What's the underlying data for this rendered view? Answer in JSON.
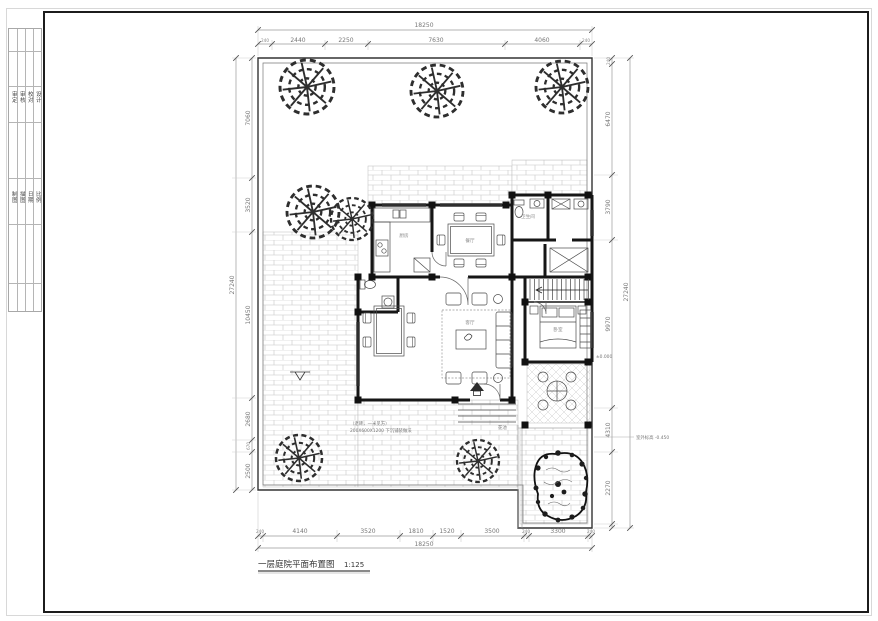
{
  "sheet": {
    "background": "#ffffff",
    "frame_color": "#1c1c1c",
    "line_color": "#222222",
    "hatch_color": "#c2c2c2"
  },
  "title": {
    "text": "一层庭院平面布置图",
    "scale": "1:125"
  },
  "title_block": {
    "group1": [
      "审定",
      "审核",
      "校对",
      "设计"
    ],
    "group2": [
      "制图",
      "描图",
      "日期",
      "比例"
    ]
  },
  "dimensions": {
    "top": {
      "overall": "18250",
      "segments": [
        "240",
        "2440",
        "2250",
        "7630",
        "4060",
        "240"
      ]
    },
    "bottom": {
      "overall": "18250",
      "segments": [
        "240",
        "4140",
        "3520",
        "1810",
        "1520",
        "3500",
        "240",
        "3300",
        "240"
      ]
    },
    "left": {
      "overall": "27240",
      "segments": [
        "7060",
        "3520",
        "10450",
        "2680",
        "670",
        "2500"
      ]
    },
    "right": {
      "overall": "27240",
      "segments": [
        "240",
        "6470",
        "3790",
        "9970",
        "4310",
        "2270"
      ]
    }
  },
  "rooms": {
    "kitchen": "厨房",
    "dining": "餐厅",
    "living": "客厅",
    "bedroom": "卧室",
    "bath": "卫生间"
  },
  "annotations": {
    "paving_note_1": "（老砖，一米见方）",
    "paving_note_2": "200X600X1200 下沉铺装做法",
    "planter": "花池",
    "outdoor_level": "室外标高 -0.450",
    "indoor_level": "±0.000"
  }
}
